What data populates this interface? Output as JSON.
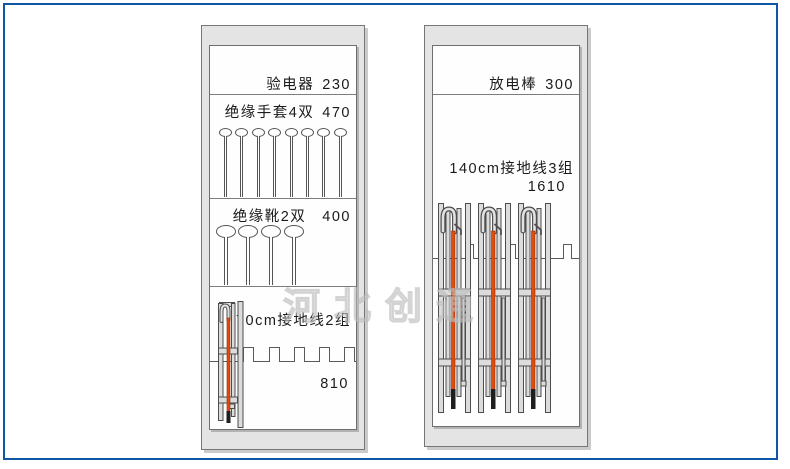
{
  "page": {
    "background": "#ffffff",
    "border_color": "#0d57a6"
  },
  "watermark": {
    "text": "河北创通"
  },
  "colors": {
    "cabinet_fill": "#e4e4e4",
    "cabinet_border": "#767676",
    "grounding_cable": "#e14b0e",
    "cable_tip": "#1f1f1f"
  },
  "cabinets": [
    {
      "sections": [
        {
          "label": "验电器",
          "value": "230"
        },
        {
          "label": "绝缘手套4双",
          "value": "470",
          "hanger_count": 8
        },
        {
          "label": "绝缘靴2双",
          "value": "400",
          "hanger_count": 4
        },
        {
          "label": "70cm接地线2组",
          "value": "810",
          "set_count": 1
        }
      ]
    },
    {
      "sections": [
        {
          "label": "放电棒",
          "value": "300"
        },
        {
          "label": "140cm接地线3组",
          "value": "1610",
          "set_count": 3
        }
      ]
    }
  ]
}
